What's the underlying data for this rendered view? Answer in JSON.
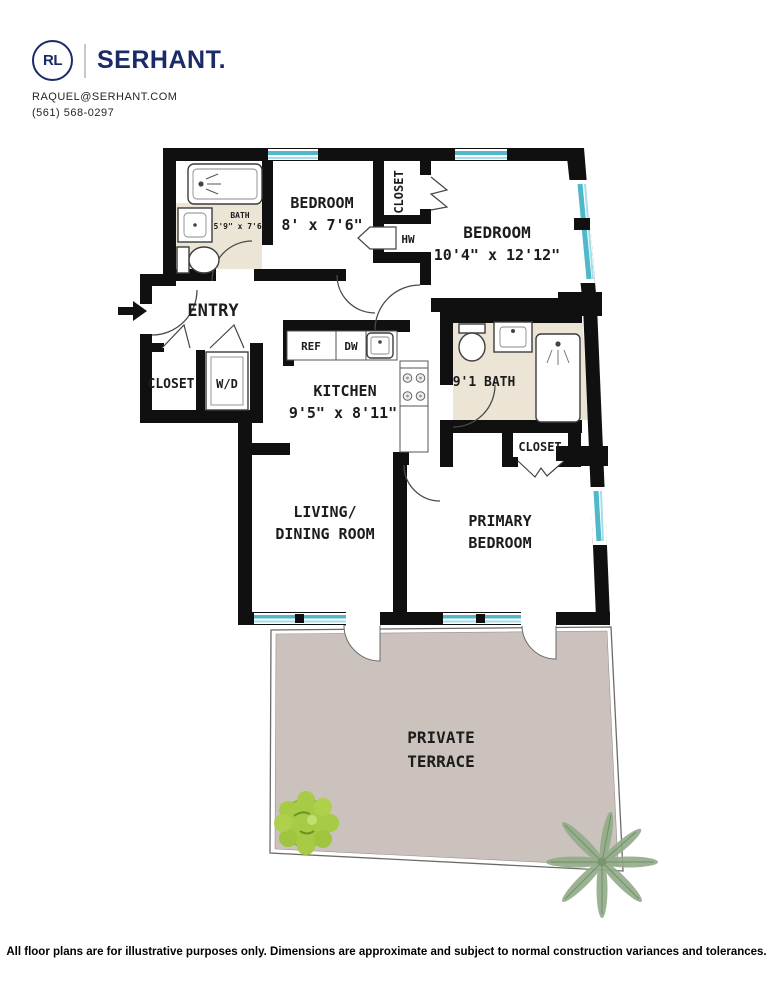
{
  "header": {
    "logo_monogram": "RL",
    "brand": "SERHANT.",
    "email": "RAQUEL@SERHANT.COM",
    "phone": "(561) 568-0297",
    "brand_color": "#1b2b68"
  },
  "floorplan": {
    "colors": {
      "wall": "#101010",
      "window_teal": "#4fb9cb",
      "window_teal_light": "#a5dee8",
      "bath_floor": "#ece5d6",
      "terrace_floor": "#cbc2bd",
      "bush_green": "#a8cb45",
      "palm_green": "#93ad8a",
      "label": "#1c1c1c"
    },
    "labels": {
      "bath1_name": "BATH",
      "bath1_dims": "5'9\" x 7'6\"",
      "bedroom1_name": "BEDROOM",
      "bedroom1_dims": "8' x 7'6\"",
      "closet1": "CLOSET",
      "hw": "HW",
      "bedroom2_name": "BEDROOM",
      "bedroom2_dims": "10'4\" x 12'12\"",
      "entry": "ENTRY",
      "closet2": "CLOSET",
      "wd": "W/D",
      "ref": "REF",
      "dw": "DW",
      "kitchen_name": "KITCHEN",
      "kitchen_dims": "9'5\" x 8'11\"",
      "bath2": "9'1 BATH",
      "closet3": "CLOSET",
      "living_line1": "LIVING/",
      "living_line2": "DINING ROOM",
      "primary_line1": "PRIMARY",
      "primary_line2": "BEDROOM",
      "terrace_line1": "PRIVATE",
      "terrace_line2": "TERRACE"
    }
  },
  "footer": {
    "disclaimer": "All floor plans are for illustrative purposes only. Dimensions are approximate and subject to normal construction variances and tolerances."
  }
}
